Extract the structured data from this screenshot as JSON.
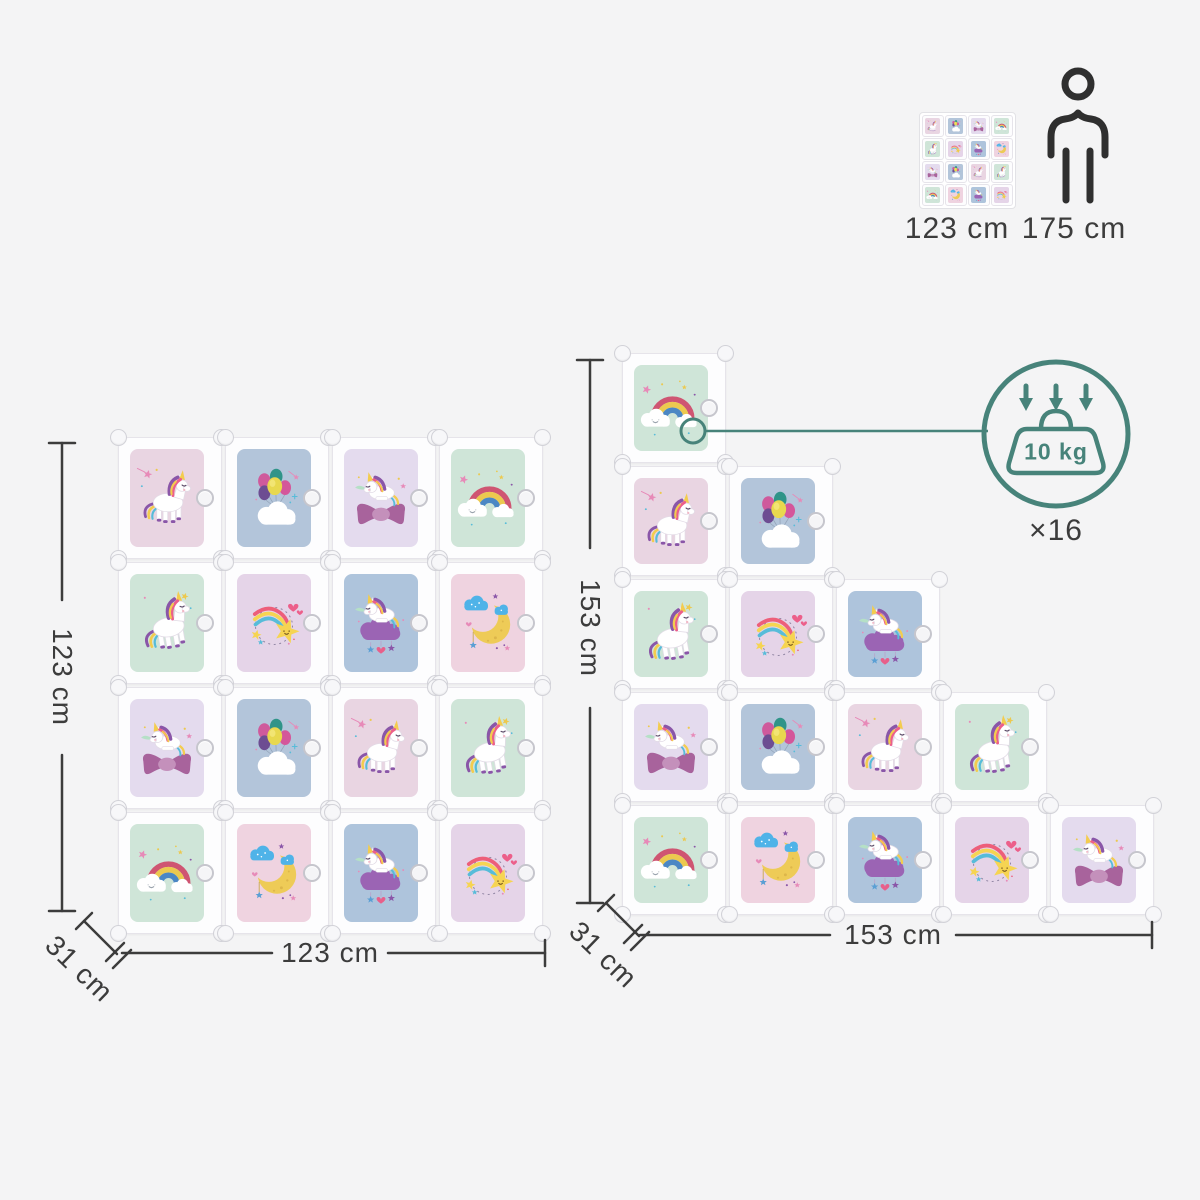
{
  "canvas": {
    "background": "#f4f4f5",
    "line_color": "#3c3c3c",
    "accent_teal": "#47837a"
  },
  "comparison": {
    "cabinet_height_label": "123 cm",
    "person_height_label": "175 cm"
  },
  "load_badge": {
    "capacity_label": "10 kg",
    "count_label": "×16"
  },
  "left_unit": {
    "height_label": "123 cm",
    "width_label": "123 cm",
    "depth_label": "31 cm",
    "rows": [
      [
        "unicorn_standing",
        "balloons",
        "unicorn_bow",
        "rainbow_cloud"
      ],
      [
        "unicorn_running",
        "shooting_star",
        "unicorn_cloud",
        "moon_clouds"
      ],
      [
        "unicorn_bow",
        "balloons",
        "unicorn_standing",
        "unicorn_running"
      ],
      [
        "rainbow_cloud",
        "moon_clouds",
        "unicorn_cloud",
        "shooting_star"
      ]
    ]
  },
  "right_unit": {
    "height_label": "153 cm",
    "width_label": "153 cm",
    "depth_label": "31 cm",
    "rows": [
      [
        "rainbow_cloud"
      ],
      [
        "unicorn_standing",
        "balloons"
      ],
      [
        "unicorn_running",
        "shooting_star",
        "unicorn_cloud"
      ],
      [
        "unicorn_bow",
        "balloons",
        "unicorn_standing",
        "unicorn_running"
      ],
      [
        "rainbow_cloud",
        "moon_clouds",
        "unicorn_cloud",
        "shooting_star",
        "unicorn_bow"
      ]
    ]
  },
  "panel_styles": {
    "unicorn_standing": {
      "bg": "#e9d5e2",
      "icon": "unicorn-standing"
    },
    "balloons": {
      "bg": "#b3c5da",
      "icon": "balloons-cloud"
    },
    "unicorn_bow": {
      "bg": "#e4dbee",
      "icon": "unicorn-bow"
    },
    "rainbow_cloud": {
      "bg": "#cfe5d8",
      "icon": "rainbow-cloud"
    },
    "unicorn_running": {
      "bg": "#cfe5d8",
      "icon": "unicorn-running"
    },
    "shooting_star": {
      "bg": "#e5d4e8",
      "icon": "shooting-star"
    },
    "unicorn_cloud": {
      "bg": "#aec4dc",
      "icon": "unicorn-cloud"
    },
    "moon_clouds": {
      "bg": "#efd3e0",
      "icon": "moon-clouds"
    }
  }
}
